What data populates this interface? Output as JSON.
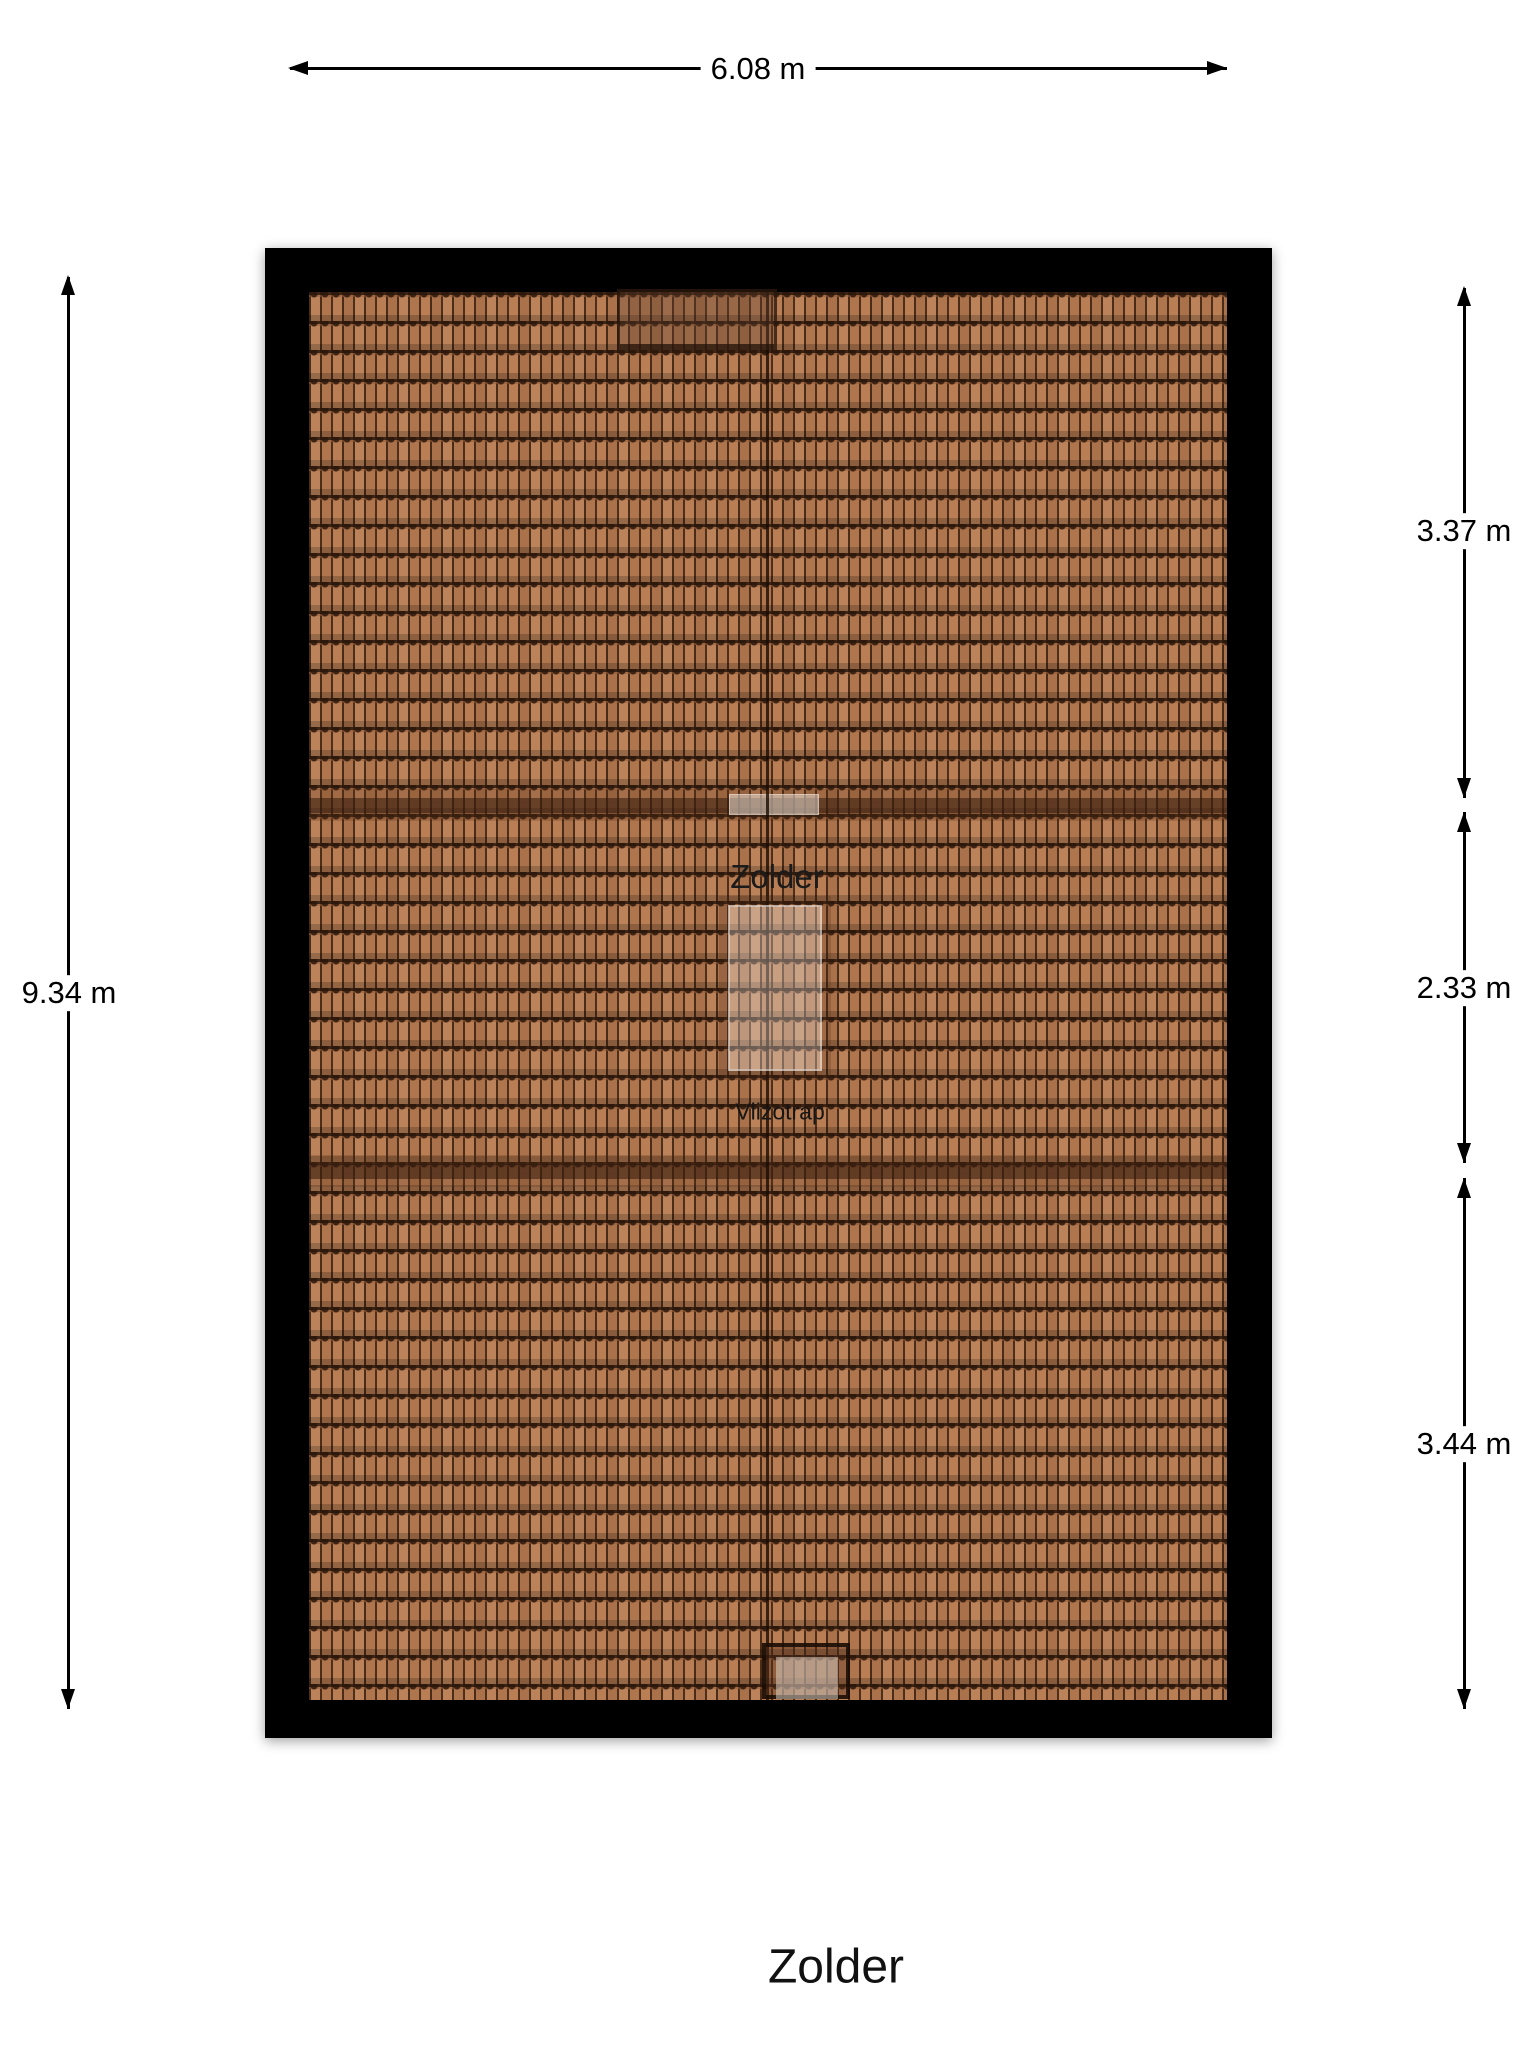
{
  "title": "Zolder",
  "plan": {
    "room_label": "Zolder",
    "hatch_label": "Vlizotrap"
  },
  "dimensions": {
    "top": "6.08 m",
    "left": "9.34 m",
    "right": [
      "3.37 m",
      "2.33 m",
      "3.44 m"
    ]
  },
  "colors": {
    "background": "#ffffff",
    "wall": "#000000",
    "tile_base": "#b87b51",
    "tile_groove": "#3a2010",
    "dimension_line": "#000000",
    "text": "#111111"
  }
}
